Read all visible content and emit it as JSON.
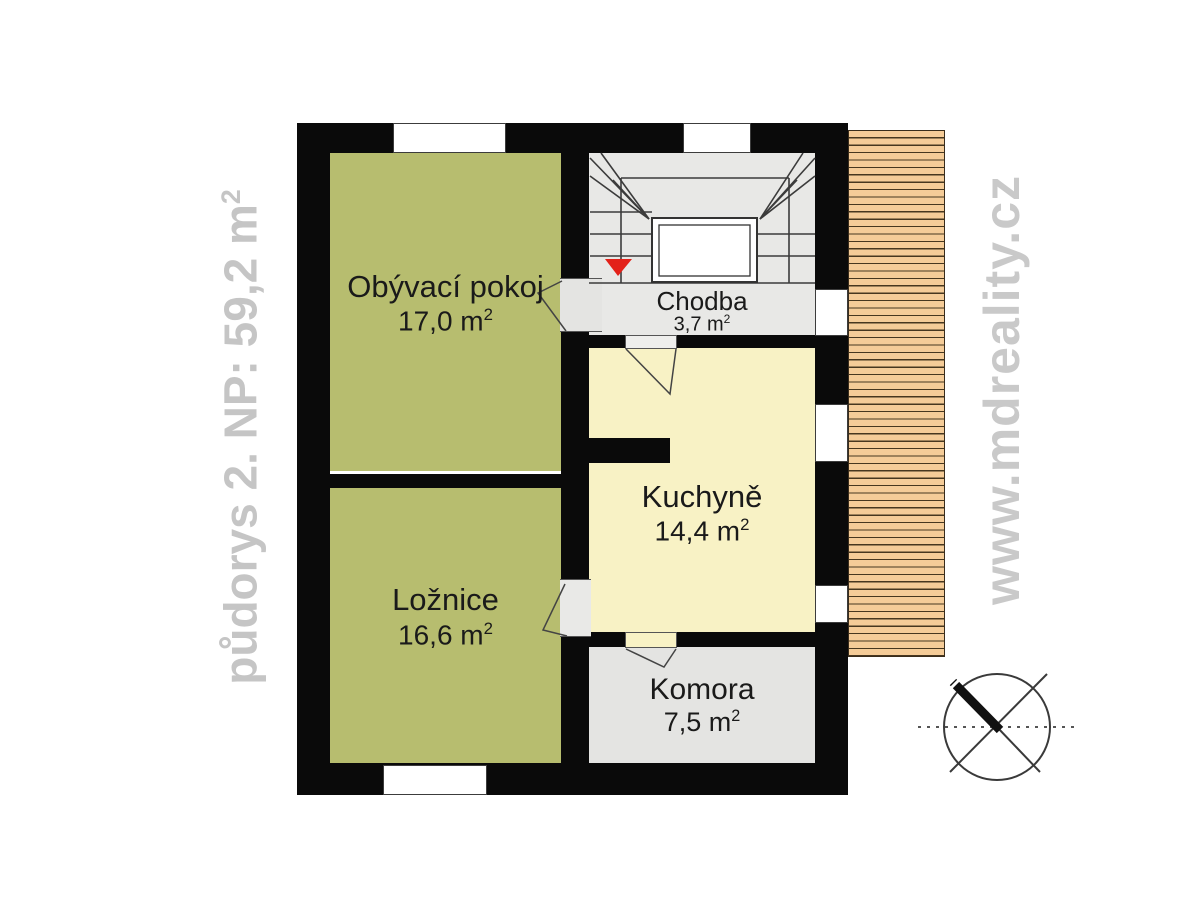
{
  "plan": {
    "title_note": "floor plan of 2nd floor",
    "rooms": {
      "living": {
        "name": "Obývací pokoj",
        "area": "17,0 m",
        "area_sup": "2"
      },
      "bedroom": {
        "name": "Ložnice",
        "area": "16,6 m",
        "area_sup": "2"
      },
      "kitchen": {
        "name": "Kuchyně",
        "area": "14,4 m",
        "area_sup": "2"
      },
      "hall": {
        "name": "Chodba",
        "area": "3,7 m",
        "area_sup": "2"
      },
      "pantry": {
        "name": "Komora",
        "area": "7,5 m",
        "area_sup": "2"
      }
    }
  },
  "watermarks": {
    "left": {
      "text": "půdorys 2. NP: 59,2 m",
      "sup": "2"
    },
    "right": {
      "text": "www.mdreality.cz"
    }
  },
  "icons": {
    "compass": "north-compass-icon",
    "stairs": "staircase-symbol",
    "down_arrow": "stair-direction-arrow"
  },
  "colors": {
    "room_green": "#b7bd6f",
    "room_yellow": "#f8f2c5",
    "room_gray": "#e8e8e6",
    "pantry_gray": "#e4e4e2",
    "wall_black": "#0a0a0a",
    "deck_orange": "#f5cc98",
    "deck_line": "#47371f",
    "watermark_gray": "#c7c7c7",
    "arrow_red": "#e32119"
  }
}
